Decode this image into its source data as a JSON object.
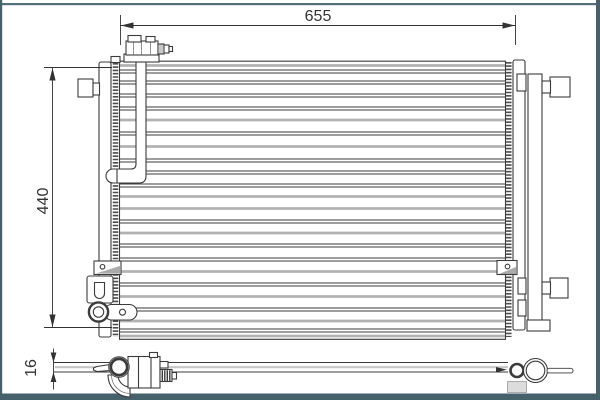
{
  "drawing": {
    "dimensions": {
      "width_label": "655",
      "height_label": "440",
      "depth_label": "16"
    }
  },
  "colors": {
    "frame": "#45616c",
    "frame_top": "#51707c",
    "line": "#3b3b3b",
    "gray_line": "#b2b2b2",
    "text": "#333333",
    "background": "#ffffff",
    "shade": "#8e8e8e"
  }
}
